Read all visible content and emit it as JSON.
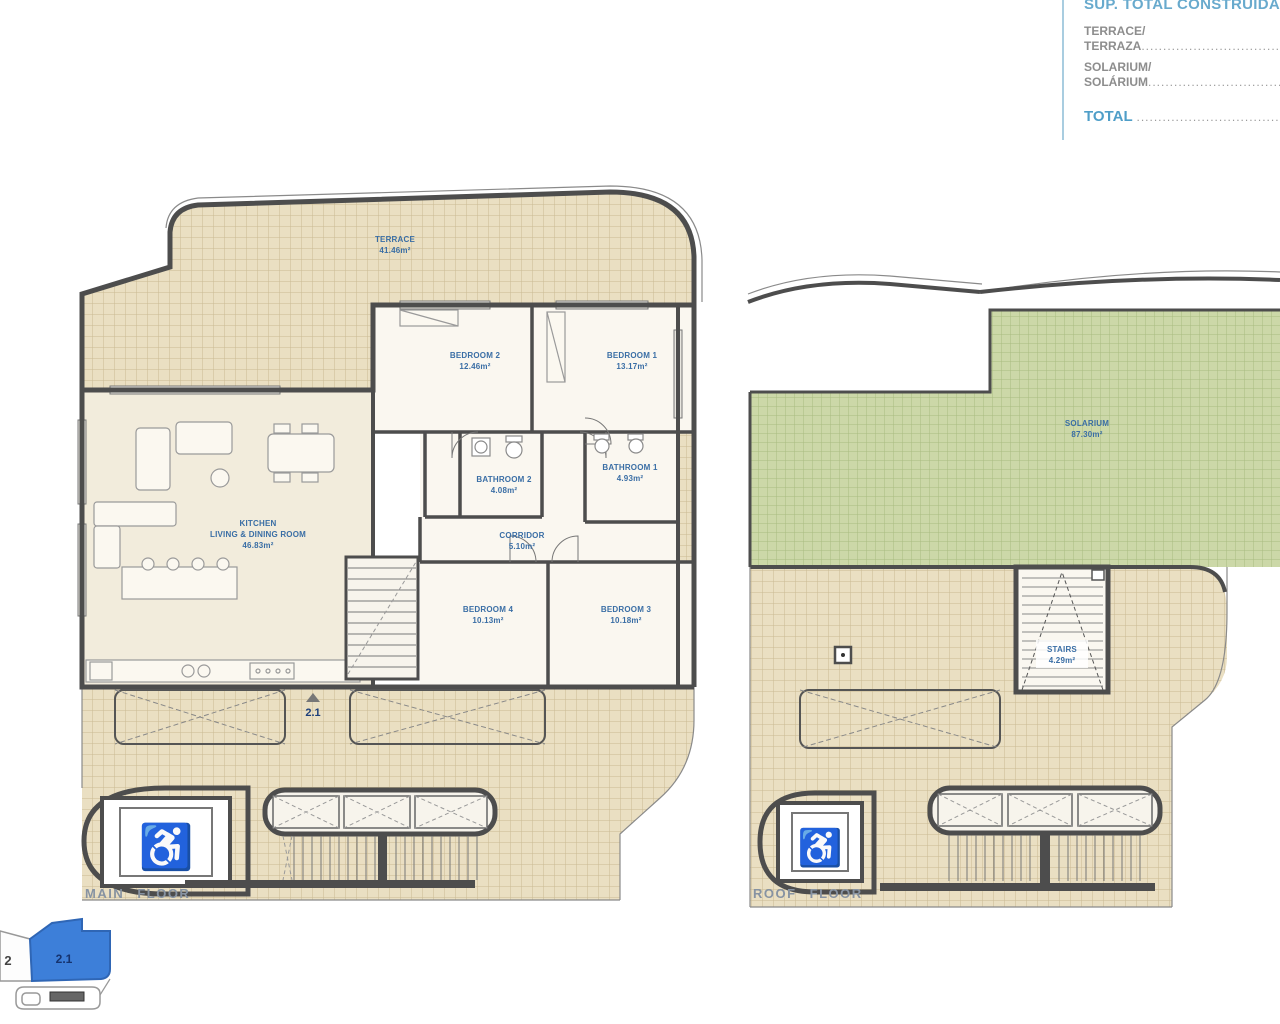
{
  "summary_panel": {
    "title": "SUP. TOTAL CONSTRUIDA",
    "items": [
      {
        "line1": "TERRACE/",
        "line2": "TERRAZA",
        "dots": "......................................................"
      },
      {
        "line1": "SOLARIUM/",
        "line2": "SOLÁRIUM",
        "dots": "...................................................."
      }
    ],
    "total": {
      "label": "TOTAL",
      "dots": "............................................................"
    }
  },
  "main_floor": {
    "caption": "MAIN FLOOR",
    "unit_marker": "2.1",
    "rooms": {
      "terrace": {
        "name": "TERRACE",
        "area": "41.46m²"
      },
      "bedroom2": {
        "name": "BEDROOM 2",
        "area": "12.46m²"
      },
      "bedroom1": {
        "name": "BEDROOM 1",
        "area": "13.17m²"
      },
      "bathroom2": {
        "name": "BATHROOM 2",
        "area": "4.08m²"
      },
      "bathroom1": {
        "name": "BATHROOM 1",
        "area": "4.93m²"
      },
      "kitchen": {
        "name": "KITCHEN",
        "name2": "LIVING & DINING ROOM",
        "area": "46.83m²"
      },
      "corridor": {
        "name": "CORRIDOR",
        "area": "5.10m²"
      },
      "bedroom4": {
        "name": "BEDROOM 4",
        "area": "10.13m²"
      },
      "bedroom3": {
        "name": "BEDROOM 3",
        "area": "10.18m²"
      }
    }
  },
  "roof_floor": {
    "caption": "ROOF FLOOR",
    "rooms": {
      "solarium": {
        "name": "SOLARIUM",
        "area": "87.30m²"
      },
      "stairs": {
        "name": "STAIRS",
        "area": "4.29m²"
      }
    }
  },
  "key_plan": {
    "unit": "2.1",
    "neighbor": "2"
  },
  "icons": {
    "wheelchair": "♿"
  },
  "colors": {
    "accent_blue": "#68aacd",
    "label_blue": "#3a6ea5",
    "tile_beige": "#eadfc2",
    "solarium_green": "#ccd8a8",
    "wall_gray": "#4d4d4d",
    "unit_highlight": "#3d7fd9"
  }
}
